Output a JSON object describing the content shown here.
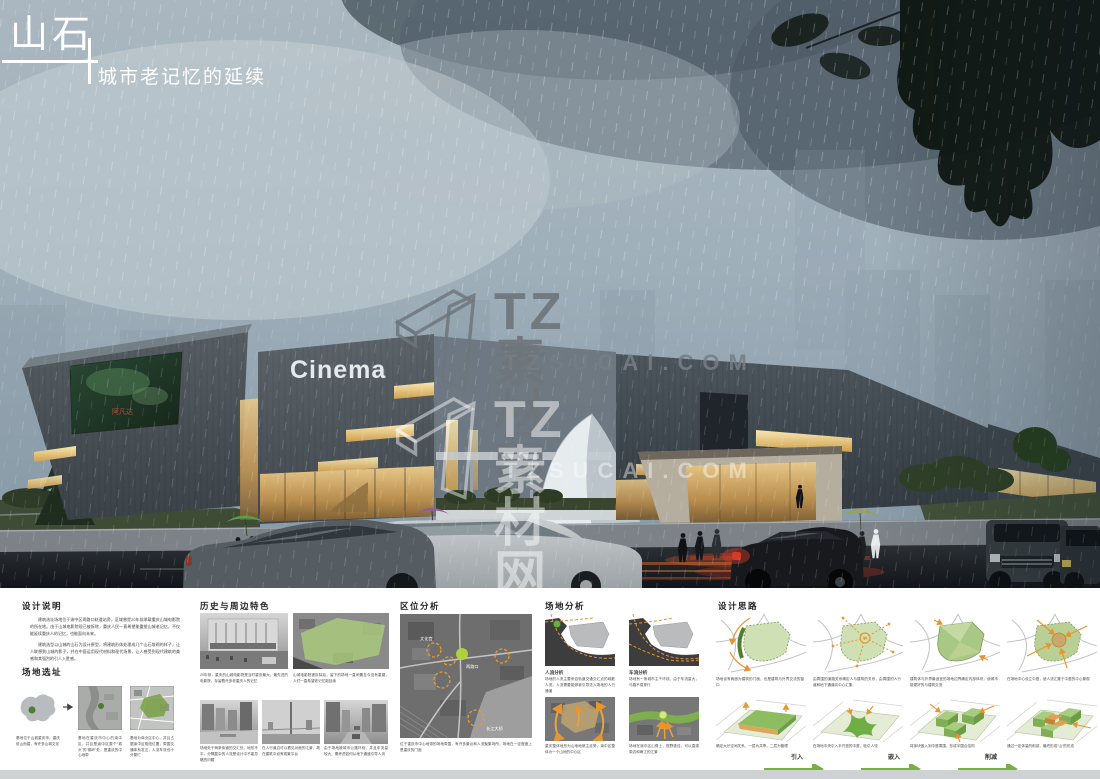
{
  "title": {
    "main": "山石",
    "subtitle": "城市老记忆的延续"
  },
  "watermark": {
    "brand": "TZ素材网",
    "domain": "TZSUCAI.COM"
  },
  "render": {
    "cinema_sign": "Cinema",
    "poster_title": "阿凡达"
  },
  "panels": {
    "design_notes": {
      "heading": "设计说明",
      "paragraphs": [
        "建筑选址场地位于渝中区两路口轨道站旁，区域曾是20年前承载重庆山城电影院的所在地。由于山城电影院现已被拆除，重庆人民一直希望能重塑山城老记忆，不仅能延续重庆人的记忆，也能面向未来。",
        "建筑选型以山城的山石为设计原型，将建筑形体处理成几个山石堆砌的样子，让人联想到山城的影子，并在中庭运用现代材料和现代场景，让人感受到现代建筑的美感和其强烈的引人入胜感。"
      ]
    },
    "site_selection": {
      "heading": "场地选址",
      "items": [
        {
          "caption": "基地位于山城重庆市，重庆依山而建，有许多山城文化"
        },
        {
          "caption": "基地在重庆市中心的渝中区，并且是渝中区整个“城头”的“鹅岭”处，是重庆的中心地带"
        },
        {
          "caption": "基地为商业区中心，并且占据渝中区枢纽位置，周围交通体系发达，人流车流也十分繁忙"
        }
      ]
    },
    "history": {
      "heading": "历史与周边特色",
      "top_items": [
        {
          "caption": "20年前，重庆的山城电影院是当时重庆最大、最先进的电影院，存留着许多老重庆人的记忆"
        },
        {
          "caption": "山城电影院被拆除后，留下的场地一直闲置至今没有重建，人们一直希望老记忆能延续"
        }
      ],
      "bottom_items": [
        {
          "caption": "场地处于两条街道的交汇处，地形不平，分隔复杂的人流是设计中不能忽略的问题"
        },
        {
          "caption": "在人行道边可以看见对面的江景，故在建筑中设有观景平台"
        },
        {
          "caption": "由于场地被城市公路环绕，并且车流量较大，需考虑如何从地下通道引导人流"
        }
      ]
    },
    "location": {
      "heading": "区位分析",
      "caption": "位于重庆市中心地带的场地周围，有许多景点和人流聚集场所，场地在一定程度上是重庆的门面",
      "map_labels": [
        "文化宫",
        "两路口",
        "长江大桥"
      ]
    },
    "site_analysis": {
      "heading": "场地分析",
      "flow": {
        "label": "人流分析",
        "caption": "场地的人流主要来自轨道交通交汇点的疏散人流，人流需要能够被引导进入场地的人行通道"
      },
      "traffic": {
        "label": "车流分析",
        "caption": "场地有一条城市主干环线，由于车流量大，马路不易穿行"
      },
      "terrain_caption": "重庆整体地形为山地地貌主走势，渝中区整体为一个山地的中心区",
      "view_caption": "场地在渝中区山脊上，视野极佳，可以直观周边和两江的江景"
    },
    "concept": {
      "heading": "设计思路",
      "row1": [
        {
          "caption": "场地设有两面为建筑的门面，也是建筑与外界交流的窗口"
        },
        {
          "caption": "由周围的道路关系确定人与建筑的关系，由周围的人行道和地下通道向中心汇集"
        },
        {
          "caption": "建筑体与外界最适宜的场地边界确定内部体块，使城市能更好的与建筑交流"
        },
        {
          "caption": "在场地中心设立中庭，使人流汇集于中庭的中心景观"
        }
      ],
      "row2": [
        {
          "caption": "确定大厅空间关系，一层为共享，二层为管理"
        },
        {
          "caption": "在场地中央引入半开放的中庭，吸引人流"
        },
        {
          "caption": "将体块嵌入到中庭周围，形成半围合结构"
        },
        {
          "caption": "通过一定体量的削减，最终形成“山”的形态"
        }
      ],
      "steps": [
        "引入",
        "嵌入",
        "削减"
      ]
    }
  }
}
